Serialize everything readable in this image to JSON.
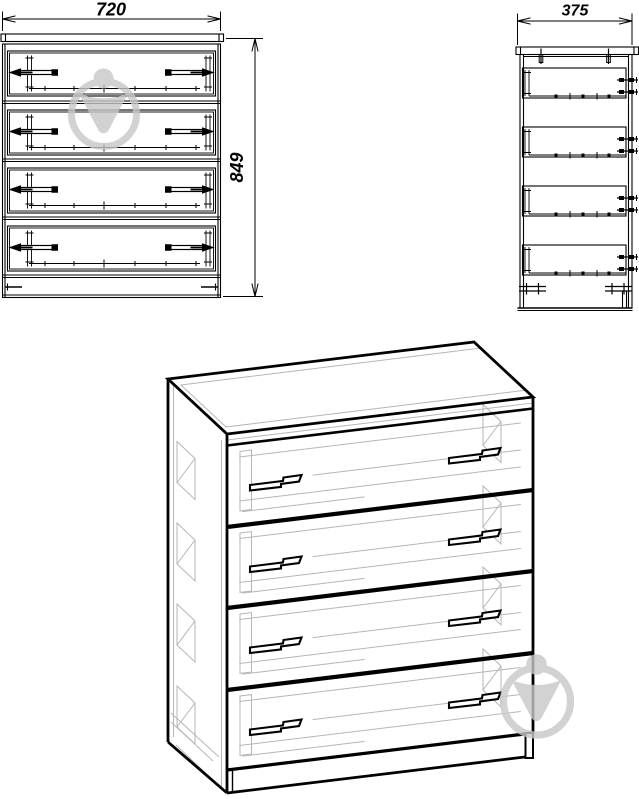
{
  "dimensions": {
    "width": "720",
    "height": "849",
    "depth": "375"
  },
  "watermark": {
    "icon": "bulb-in-circle-watermark",
    "count": 2
  },
  "colors": {
    "line": "#000000",
    "hidden_line": "#b6b6b6",
    "watermark": "#c8c8c8",
    "background": "#ffffff"
  }
}
